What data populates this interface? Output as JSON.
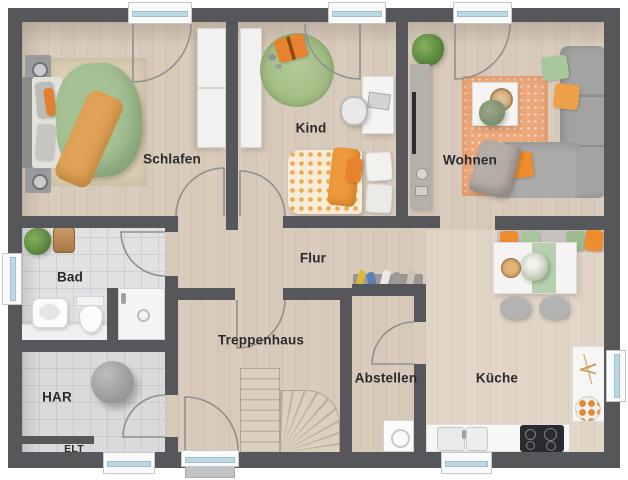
{
  "plan": {
    "rooms": {
      "schlafen": "Schlafen",
      "kind": "Kind",
      "wohnen": "Wohnen",
      "bad": "Bad",
      "flur": "Flur",
      "treppenhaus": "Treppenhaus",
      "abstellen": "Abstellen",
      "kueche": "Küche",
      "har": "HAR",
      "elt": "ELT"
    },
    "palette": {
      "wall": "#56575b",
      "wood_floor": "#d7c9b9",
      "tile_floor": "#e0e1e3",
      "accent_orange": "#e98a3c",
      "accent_green": "#a8c494",
      "window_glass": "#bdd8e5",
      "label_color": "#2b2b2b"
    }
  }
}
